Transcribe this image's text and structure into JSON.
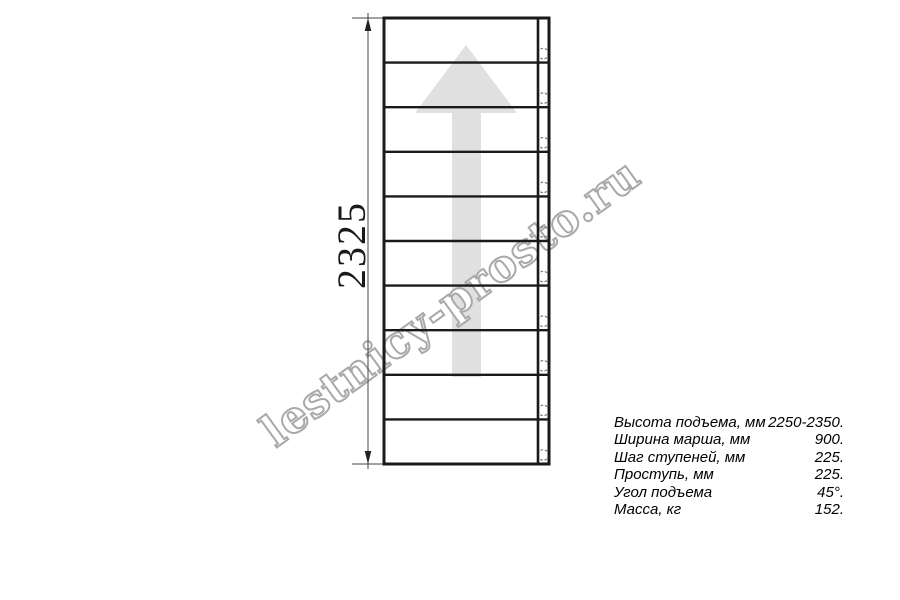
{
  "watermark": {
    "text": "lestnicy-prosto.ru",
    "stroke_color": "#a9a9a9",
    "fill_color": "#ffffff",
    "angle_deg": -36
  },
  "drawing": {
    "dimension_label": "2325",
    "steps": 10,
    "arrow_color": "#e0e0e0",
    "line_color": "#1a1a1a",
    "thin_line_color": "#444444",
    "circle_color": "#777777"
  },
  "specs": {
    "rows": [
      {
        "label": "Высота подъема, мм",
        "value": "2250-2350."
      },
      {
        "label": "Ширина марша, мм",
        "value": "900."
      },
      {
        "label": "Шаг ступеней, мм",
        "value": "225."
      },
      {
        "label": "Проступь, мм",
        "value": "225."
      },
      {
        "label": "Угол подъема",
        "value": "45°."
      },
      {
        "label": "Масса, кг",
        "value": "152."
      }
    ]
  }
}
